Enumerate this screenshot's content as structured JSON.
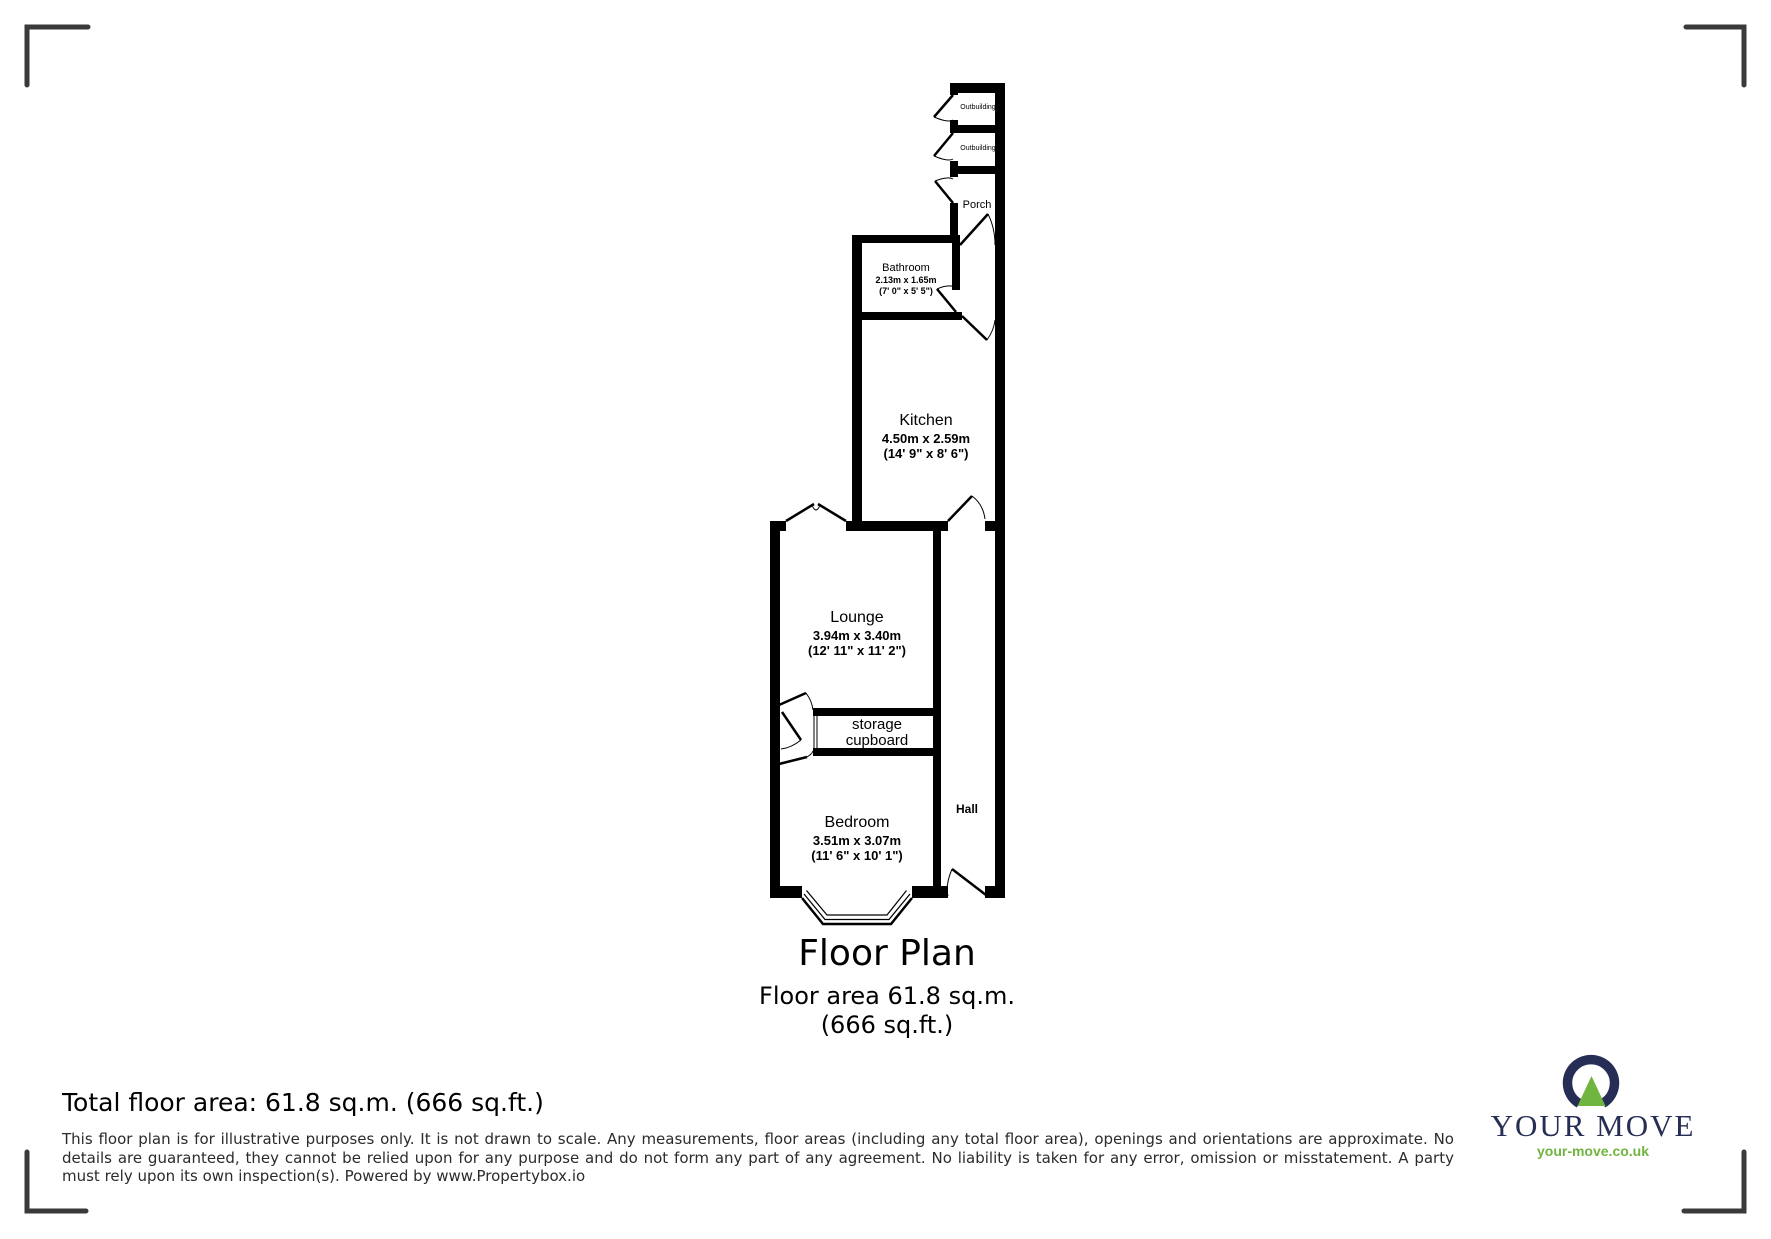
{
  "rooms": {
    "outbuilding1": {
      "label": "Outbuilding"
    },
    "outbuilding2": {
      "label": "Outbuilding"
    },
    "porch": {
      "label": "Porch"
    },
    "bathroom": {
      "label": "Bathroom",
      "metric": "2.13m x 1.65m",
      "imperial": "(7' 0\" x 5' 5\")"
    },
    "kitchen": {
      "label": "Kitchen",
      "metric": "4.50m x 2.59m",
      "imperial": "(14' 9\" x 8' 6\")"
    },
    "lounge": {
      "label": "Lounge",
      "metric": "3.94m x 3.40m",
      "imperial": "(12' 11\" x 11' 2\")"
    },
    "storage": {
      "line1": "storage",
      "line2": "cupboard"
    },
    "bedroom": {
      "label": "Bedroom",
      "metric": "3.51m x 3.07m",
      "imperial": "(11' 6\" x 10' 1\")"
    },
    "hall": {
      "label": "Hall"
    }
  },
  "title": {
    "heading": "Floor Plan",
    "area_line1": "Floor area 61.8 sq.m.",
    "area_line2": "(666 sq.ft.)"
  },
  "footer": {
    "total": "Total floor area: 61.8 sq.m. (666 sq.ft.)",
    "disclaimer": "This floor plan is for illustrative purposes only. It is not drawn to scale. Any measurements, floor areas (including any total floor area), openings and orientations are approximate. No details are guaranteed, they cannot be relied upon for any purpose and do not form any part of any agreement. No liability is taken for any error, omission or misstatement. A party must rely upon its own inspection(s). Powered by www.Propertybox.io"
  },
  "brand": {
    "name": "YOUR MOVE",
    "url": "your-move.co.uk",
    "navy": "#272e55",
    "green": "#6fb53f"
  },
  "icons": {
    "brand_mark": "your-move-logo-mark",
    "corner_marks": "crop-corner-brackets"
  },
  "colors": {
    "wall": "#000000",
    "bracket": "#3a3a3a",
    "text": "#000000",
    "disclaimer_text": "#2b2b2b"
  }
}
